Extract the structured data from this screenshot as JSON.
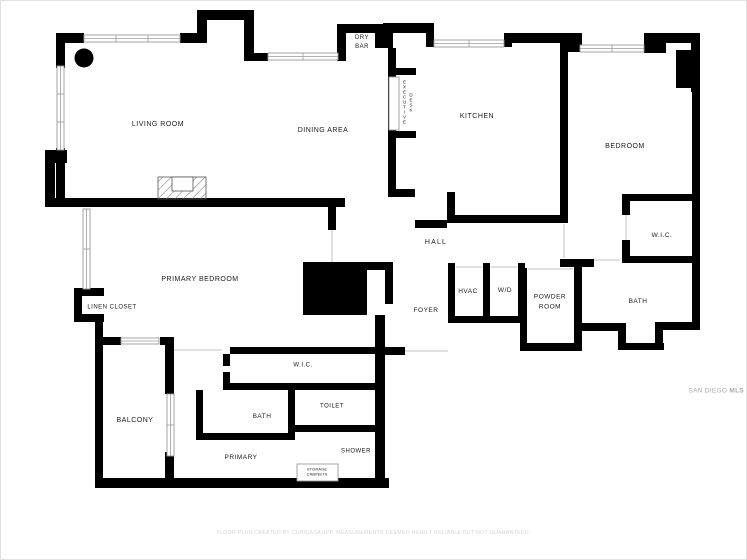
{
  "title": "Residential floor plan",
  "colors": {
    "wall": "#000000",
    "window-line": "#9a9a9a",
    "door-line": "#cfcfcf",
    "label": "#1a1a1a",
    "disclaimer": "#d8d4d4",
    "watermark": "#a8a8a8",
    "page-border": "#e2e2e2"
  },
  "rooms": [
    {
      "id": "living-room",
      "label": "LIVING ROOM"
    },
    {
      "id": "dining-area",
      "label": "DINING AREA"
    },
    {
      "id": "dry-bar",
      "label": "DRY\nBAR"
    },
    {
      "id": "kitchen",
      "label": "KITCHEN"
    },
    {
      "id": "bedroom",
      "label": "BEDROOM"
    },
    {
      "id": "wic-bedroom",
      "label": "W.I.C."
    },
    {
      "id": "bath-bedroom",
      "label": "BATH"
    },
    {
      "id": "hall",
      "label": "HALL"
    },
    {
      "id": "hvac",
      "label": "HVAC"
    },
    {
      "id": "washer-dryer",
      "label": "W/D"
    },
    {
      "id": "powder-room",
      "label": "POWDER\nROOM"
    },
    {
      "id": "foyer",
      "label": "FOYER"
    },
    {
      "id": "primary-bedroom",
      "label": "PRIMARY BEDROOM"
    },
    {
      "id": "linen-closet",
      "label": "LINEN CLOSET"
    },
    {
      "id": "balcony",
      "label": "BALCONY"
    },
    {
      "id": "wic-primary",
      "label": "W.I.C."
    },
    {
      "id": "bath-primary",
      "label": "BATH"
    },
    {
      "id": "toilet",
      "label": "TOILET"
    },
    {
      "id": "primary",
      "label": "PRIMARY"
    },
    {
      "id": "shower",
      "label": "SHOWER"
    },
    {
      "id": "storage-cabinets",
      "label": "STORAGE\nCABINETS"
    }
  ],
  "fixtures": {
    "executive_desk": {
      "word1": "EXECUTIVE",
      "word2": "DESK"
    }
  },
  "footer": {
    "disclaimer": "FLOOR PLAN CREATED BY CUBICASA APP. MEASUREMENTS DEEMED HIGHLY RELIABLE BUT NOT GUARANTEED."
  },
  "watermark": {
    "part1": "SAN DIEGO",
    "part2": "MLS"
  }
}
